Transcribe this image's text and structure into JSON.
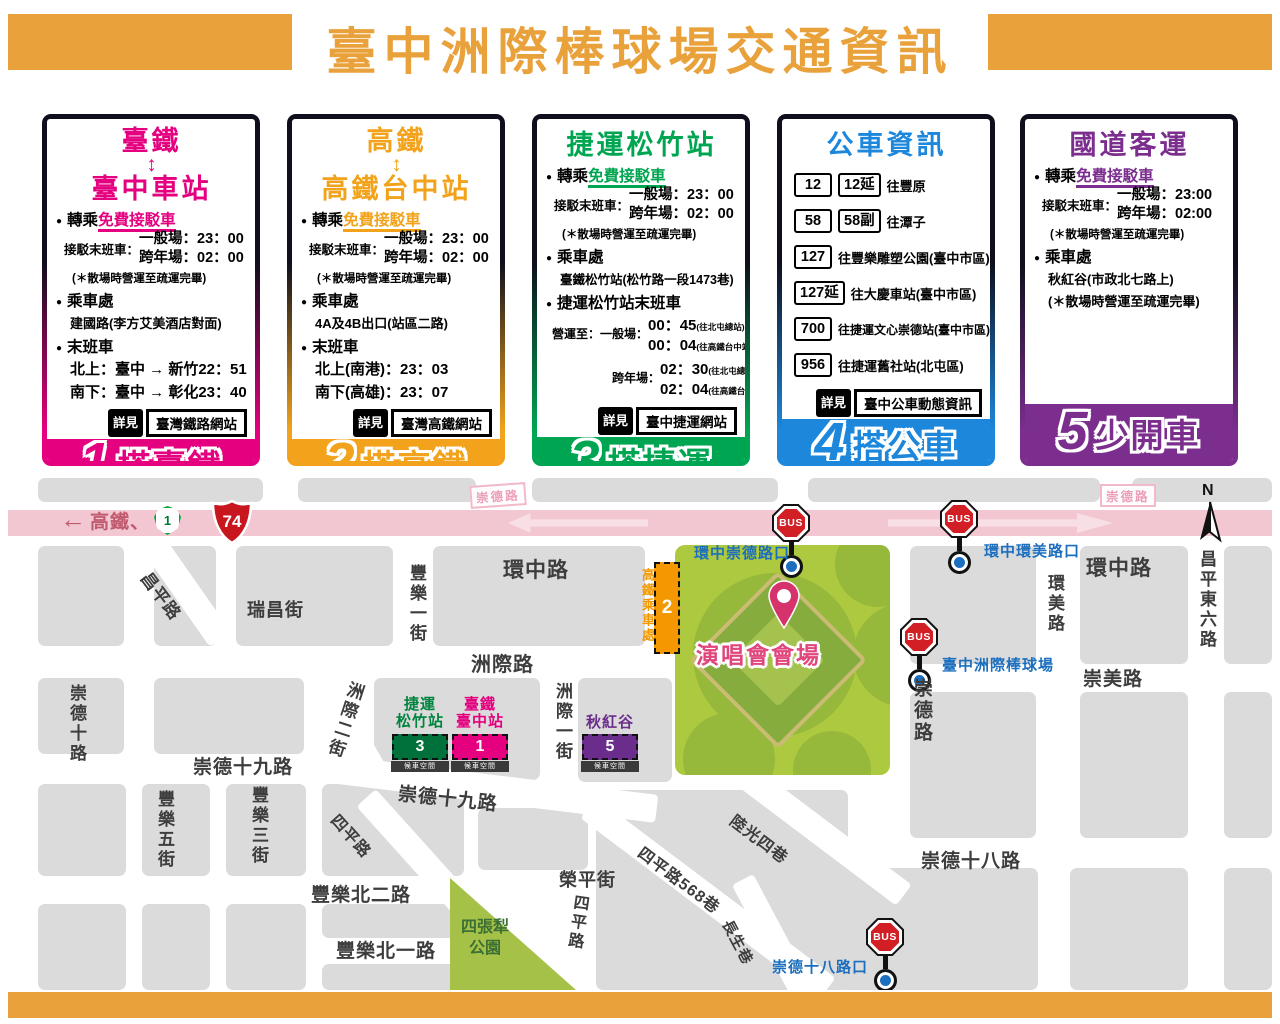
{
  "header": {
    "title": "臺中洲際棒球場交通資訊"
  },
  "colors": {
    "header_orange": "#E9A23B",
    "tra_pink": "#E4007F",
    "hsr_gold": "#F2A31B",
    "mrt_green": "#00A551",
    "bus_blue": "#1D87DC",
    "coach_purple": "#7B2E8E",
    "bus_stop_blue": "#1C6FBE",
    "highway_pink": "#F2C7D1",
    "stadium_green": "#ADC93F"
  },
  "cards": [
    {
      "title_top": "臺鐵",
      "arrow": "↕",
      "title_bottom": "臺中車站",
      "transfer_prefix": "轉乘",
      "transfer_link": "免費接駁車",
      "sched_label": "接駁末班車：",
      "sched": [
        "一般場：23：00",
        "跨年場：02：00"
      ],
      "note": "(＊散場時營運至疏運完畢)",
      "boarding_label": "乘車處",
      "boarding": "建國路(李方艾美酒店對面)",
      "last_label": "末班車",
      "trains": [
        "北上：臺中 → 新竹22：51",
        "南下：臺中 → 彰化23：40"
      ],
      "see_tag": "詳見",
      "see": "臺灣鐵路網站",
      "num": "1",
      "slogan": "搭臺鐵"
    },
    {
      "title_top": "高鐵",
      "arrow": "↕",
      "title_bottom": "高鐵台中站",
      "transfer_prefix": "轉乘",
      "transfer_link": "免費接駁車",
      "sched_label": "接駁末班車：",
      "sched": [
        "一般場：23：00",
        "跨年場：02：00"
      ],
      "note": "(＊散場時營運至疏運完畢)",
      "boarding_label": "乘車處",
      "boarding": "4A及4B出口(站區二路)",
      "last_label": "末班車",
      "trains": [
        "北上(南港)：23：03",
        "南下(高雄)：23：07"
      ],
      "see_tag": "詳見",
      "see": "臺灣高鐵網站",
      "num": "2",
      "slogan": "搭高鐵"
    },
    {
      "title": "捷運松竹站",
      "transfer_prefix": "轉乘",
      "transfer_link": "免費接駁車",
      "sched_label": "接駁末班車：",
      "sched": [
        "一般場：23：00",
        "跨年場：02：00"
      ],
      "note": "(＊散場時營運至疏運完畢)",
      "boarding_label": "乘車處",
      "boarding": "臺鐵松竹站(松竹路一段1473巷)",
      "last_label": "捷運松竹站末班車",
      "oper_label1": "營運至：一般場：",
      "oper1": [
        {
          "time": "00：45",
          "dest": "(往北屯總站)"
        },
        {
          "time": "00：04",
          "dest": "(往高鐵台中站)"
        }
      ],
      "oper_label2": "跨年場：",
      "oper2": [
        {
          "time": "02：30",
          "dest": "(往北屯總站)"
        },
        {
          "time": "02：04",
          "dest": "(往高鐵台中站)"
        }
      ],
      "see_tag": "詳見",
      "see": "臺中捷運網站",
      "num": "3",
      "slogan": "搭捷運"
    },
    {
      "title": "公車資訊",
      "routes": [
        {
          "badges": [
            "12",
            "12延"
          ],
          "dest": "往豐原"
        },
        {
          "badges": [
            "58",
            "58副"
          ],
          "dest": "往潭子"
        },
        {
          "badges": [
            "127"
          ],
          "dest": "往豐樂雕塑公園(臺中市區)"
        },
        {
          "badges": [
            "127延"
          ],
          "dest": "往大慶車站(臺中市區)"
        },
        {
          "badges": [
            "700"
          ],
          "dest": "往捷運文心崇德站(臺中市區)"
        },
        {
          "badges": [
            "956"
          ],
          "dest": "往捷運舊社站(北屯區)"
        }
      ],
      "see_tag": "詳見",
      "see": "臺中公車動態資訊",
      "num": "4",
      "slogan": "搭公車"
    },
    {
      "title": "國道客運",
      "transfer_prefix": "轉乘",
      "transfer_link": "免費接駁車",
      "sched_label": "接駁末班車：",
      "sched": [
        "一般場：23:00",
        "跨年場：02:00"
      ],
      "note": "(＊散場時營運至疏運完畢)",
      "boarding_label": "乘車處",
      "boarding": "秋紅谷(市政北七路上)",
      "note2": "(＊散場時營運至疏運完畢)",
      "num": "5",
      "slogan": "少開車"
    }
  ],
  "map": {
    "legend": {
      "arrow": "←",
      "text": "高鐵、",
      "shield_provincial": "1",
      "shield_expressway": "74"
    },
    "road_tag_left": "崇德路",
    "road_tag_right": "崇德路",
    "compass": "N",
    "bus_sign": "BUS",
    "bus_stops": [
      "環中崇德路口",
      "環中環美路口",
      "臺中洲際棒球場",
      "崇德十八路口"
    ],
    "venue_label": "演唱會會場",
    "hsr_boarding": {
      "label": "高鐵乘車處",
      "num": "2"
    },
    "shuttle_points": [
      {
        "line1": "捷運",
        "line2": "松竹站",
        "num": "3",
        "sub": "候車空間",
        "color": "#00713B",
        "text_color": "#00843D"
      },
      {
        "line1": "臺鐵",
        "line2": "臺中站",
        "num": "1",
        "sub": "候車空間",
        "color": "#E4007F",
        "text_color": "#E4007F"
      },
      {
        "line1": "秋紅谷",
        "line2": "",
        "num": "5",
        "sub": "候車空間",
        "color": "#6B2D8B",
        "text_color": "#6B2D8B"
      }
    ],
    "park": {
      "line1": "四張犁",
      "line2": "公園"
    },
    "streets": [
      "環中路",
      "瑞昌街",
      "昌平路",
      "豐樂一街",
      "洲際路",
      "崇德十路",
      "洲際二街",
      "洲際一街",
      "崇德十九路",
      "崇德十九路",
      "豐樂五街",
      "豐樂三街",
      "豐樂北二路",
      "豐樂北一路",
      "榮平街",
      "四平路",
      "四平路",
      "四平路568巷",
      "陸光四巷",
      "長生巷",
      "環中路",
      "環美路",
      "昌平東六路",
      "崇美路",
      "崇德路",
      "崇德十八路"
    ]
  }
}
